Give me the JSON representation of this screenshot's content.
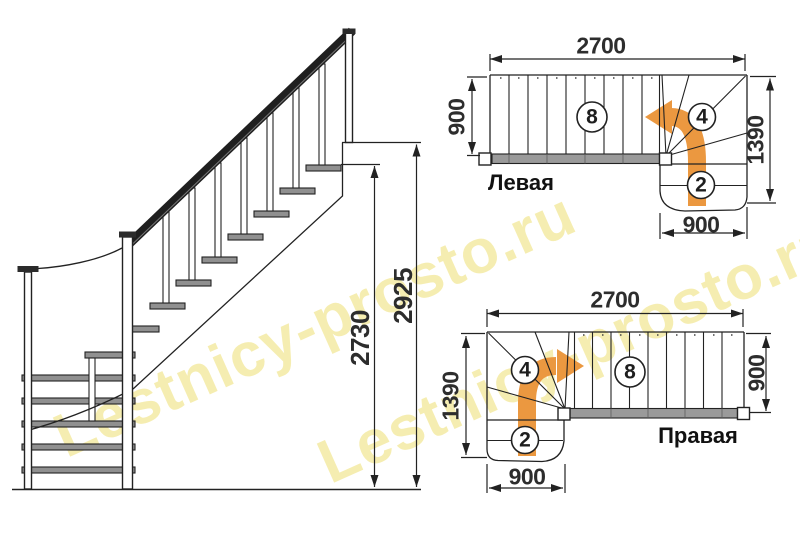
{
  "watermark": {
    "text": "Lestnicy-prosto.ru",
    "color": "#F5ECA9"
  },
  "colors": {
    "accent_orange": "#EB9840",
    "line": "#222222",
    "tread_gray": "#909090",
    "stringer_gray": "#9A9A9A",
    "dim_text": "#2D2D2D"
  },
  "elevation": {
    "total_height": "2925",
    "flight_height": "2730"
  },
  "plan_left": {
    "label": "Левая",
    "dim_top": "2700",
    "dim_left": "900",
    "dim_right": "1390",
    "dim_bottom": "900",
    "flight_steps": "8",
    "winder_steps": "4",
    "lower_steps": "2"
  },
  "plan_right": {
    "label": "Правая",
    "dim_top": "2700",
    "dim_left": "1390",
    "dim_right": "900",
    "dim_bottom": "900",
    "flight_steps": "8",
    "winder_steps": "4",
    "lower_steps": "2"
  }
}
